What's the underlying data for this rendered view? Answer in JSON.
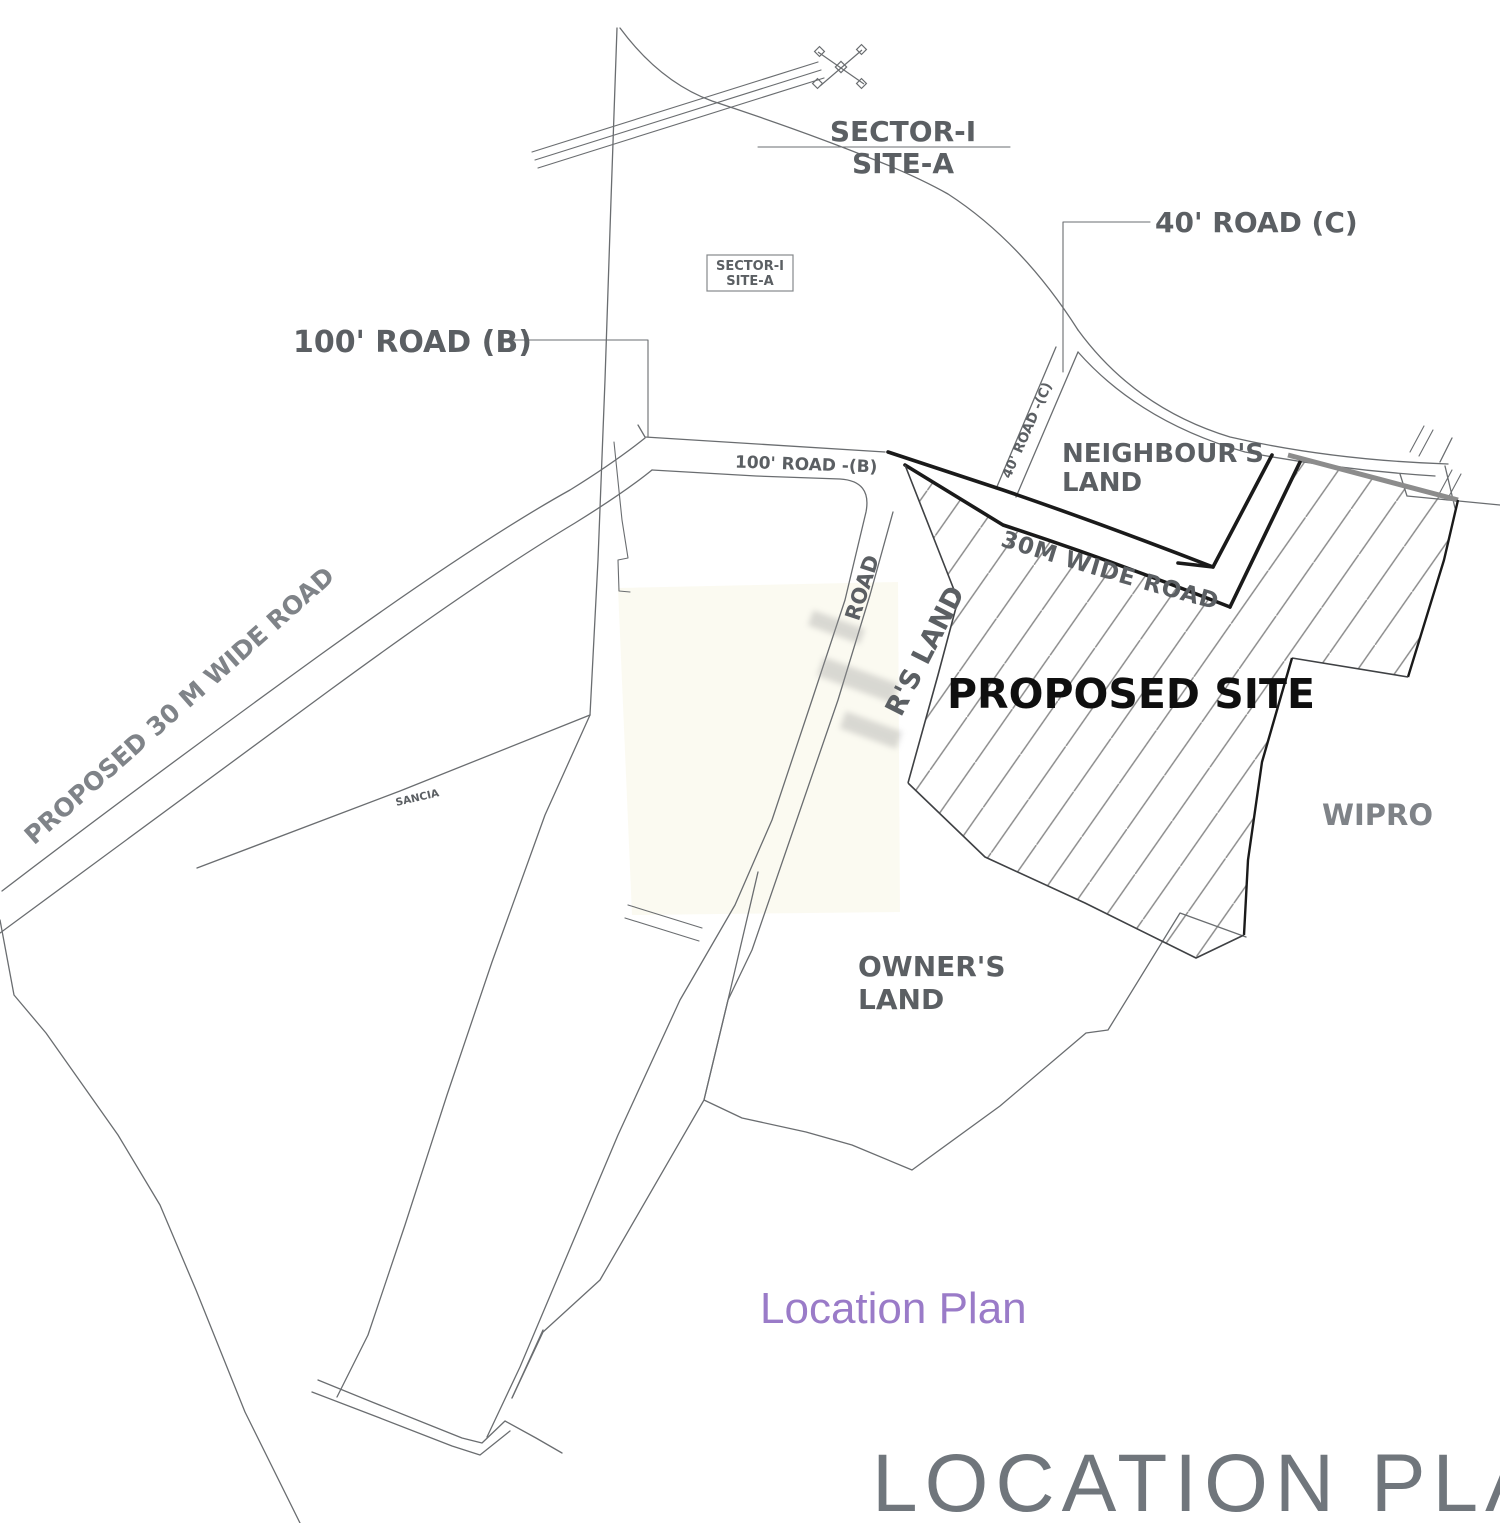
{
  "plan": {
    "caption": "Location Plan",
    "title": "LOCATION PLAN"
  },
  "labels": {
    "sector_site_title": {
      "line1": "SECTOR-I",
      "line2": "SITE-A"
    },
    "sector_site_box": {
      "line1": "SECTOR-I",
      "line2": "SITE-A"
    },
    "road_40_callout": "40' ROAD (C)",
    "road_100_callout": "100' ROAD (B)",
    "road_100_inline": "100' ROAD -(B)",
    "road_30m_inline": "30M WIDE ROAD",
    "road_40_inline": "40' ROAD -(C)",
    "proposed_30m_road": "PROPOSED 30 M WIDE ROAD",
    "corridor_road": "ROAD",
    "corridor_land": "R'S LAND",
    "neighbours_land": {
      "line1": "NEIGHBOUR'S",
      "line2": "LAND"
    },
    "proposed_site": "PROPOSED SITE",
    "wipro": "WIPRO",
    "owners_land": {
      "line1": "OWNER'S",
      "line2": "LAND"
    },
    "sancia": "SANCIA"
  },
  "colors": {
    "line": "#6a6d70",
    "thick_boundary": "#1a1a1a",
    "road_front_gray": "#8c8c8c",
    "label_gray": "#5b5f63",
    "label_dark": "#0f0f0f",
    "caption_purple": "#9a7bc8",
    "title_gray": "#70767c",
    "hatch": "#8a8a8a"
  }
}
